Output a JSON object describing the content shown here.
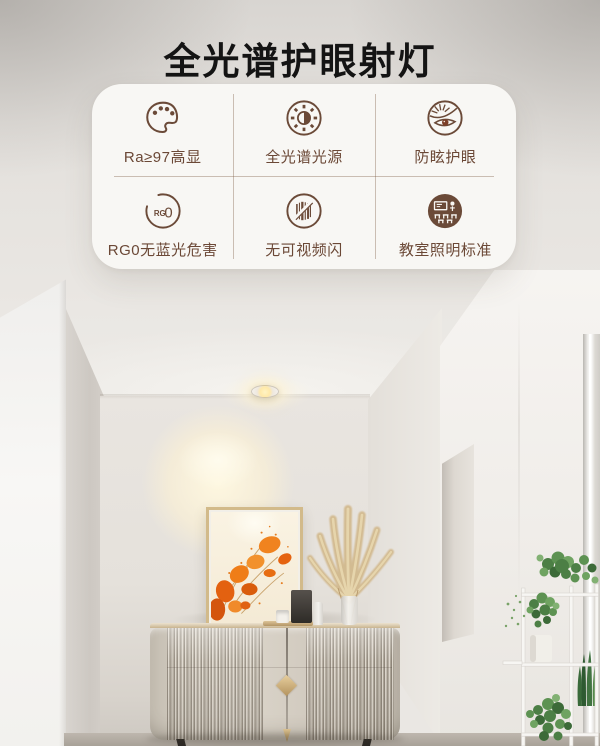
{
  "title": "全光谱护眼射灯",
  "features": [
    {
      "label": "Ra≥97高显",
      "icon": "palette-icon"
    },
    {
      "label": "全光谱光源",
      "icon": "full-spectrum-light-icon"
    },
    {
      "label": "防眩护眼",
      "icon": "anti-glare-eye-icon"
    },
    {
      "label": "RG0无蓝光危害",
      "icon": "rg0-badge-icon"
    },
    {
      "label": "无可视频闪",
      "icon": "no-flicker-icon"
    },
    {
      "label": "教室照明标准",
      "icon": "classroom-lighting-icon"
    }
  ],
  "rg0_badge": {
    "small": "RG",
    "big": "0"
  },
  "colors": {
    "icon_brown": "#6b4a38",
    "label_brown": "#6b4836",
    "card_bg": "#f8f7f4",
    "accent_gold": "#c9a878",
    "art_orange": "#e8650f",
    "plant_green": "#4c7f45",
    "spot_warm": "#ffe9a9",
    "title_black": "#141414"
  }
}
